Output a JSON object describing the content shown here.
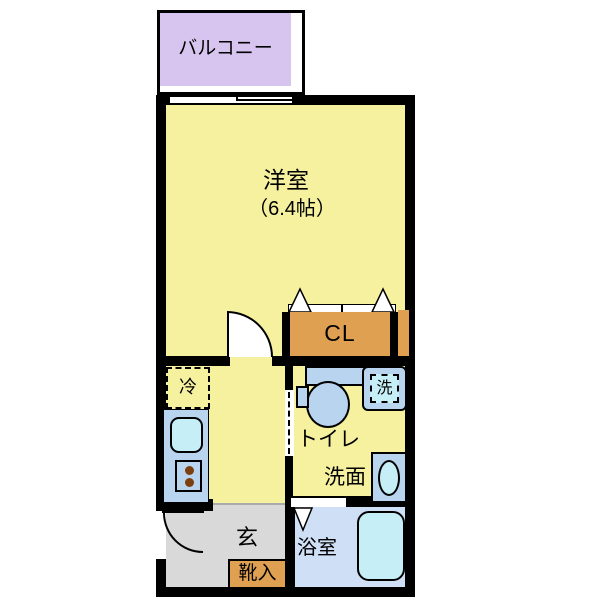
{
  "title": "floor-plan",
  "rooms": {
    "balcony": {
      "label": "バルコニー"
    },
    "western_room": {
      "label": "洋室",
      "size": "（6.4帖）"
    },
    "closet": {
      "label": "CL"
    },
    "refrigerator_space": {
      "label": "冷"
    },
    "toilet": {
      "label": "トイレ"
    },
    "washroom": {
      "label": "洗面"
    },
    "laundry_space": {
      "label": "洗"
    },
    "entrance": {
      "label": "玄"
    },
    "shoe_cabinet": {
      "label": "靴入"
    },
    "bathroom": {
      "label": "浴室"
    }
  },
  "colors": {
    "room_yellow": "#f6f19f",
    "balcony_purple": "#d7c5f0",
    "closet_orange": "#dfa052",
    "counter_blue": "#b9d4ef",
    "fixture_blue": "#c6eef6",
    "bath_floor_blue": "#cfdff6",
    "entrance_gray": "#d9d9d9",
    "wall_black": "#000000",
    "burner_brown": "#7b3f10"
  }
}
